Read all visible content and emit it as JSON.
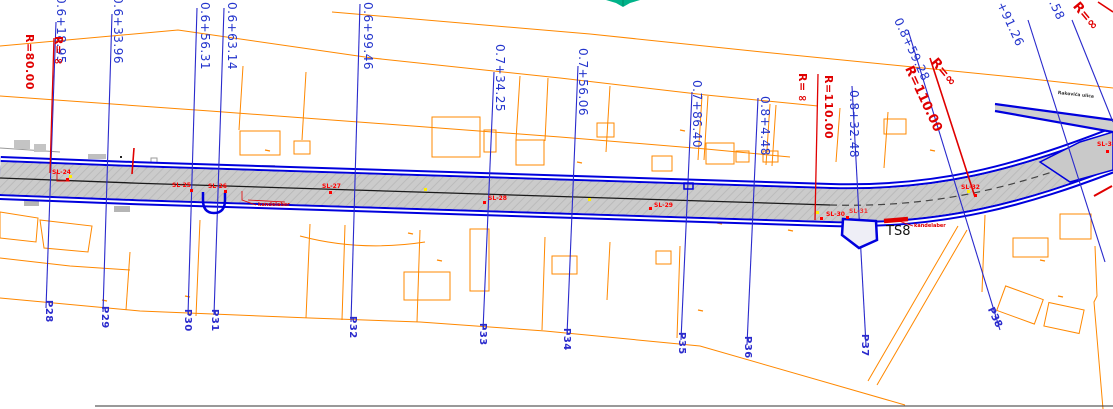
{
  "stations": [
    {
      "chainage": "0.6+18.95",
      "point": "P28"
    },
    {
      "chainage": "0.6+33.96",
      "point": "P29"
    },
    {
      "chainage": "0.6+56.31",
      "point": "P30"
    },
    {
      "chainage": "0.6+63.14",
      "point": "P31"
    },
    {
      "chainage": "0.6+99.46",
      "point": "P32"
    },
    {
      "chainage": "0.7+34.25",
      "point": "P33"
    },
    {
      "chainage": "0.7+56.06",
      "point": "P34"
    },
    {
      "chainage": "0.7+86.40",
      "point": "P35"
    },
    {
      "chainage": "0.8+4.48",
      "point": "P36"
    },
    {
      "chainage": "0.8+32.48",
      "point": "P37"
    },
    {
      "chainage": "0.8+59.28",
      "point": "P38"
    },
    {
      "chainage": "+91.26",
      "point": ""
    },
    {
      "chainage": ".58",
      "point": ""
    }
  ],
  "radius_labels": [
    {
      "value": "R=∞"
    },
    {
      "value": "R=80.00"
    },
    {
      "value": "R=∞"
    },
    {
      "value": "R=110.00"
    },
    {
      "value": "R=110.00"
    },
    {
      "value": "R=∞"
    },
    {
      "value": "R=∞"
    }
  ],
  "sl_points": [
    {
      "label": "SL-24"
    },
    {
      "label": "SL-25"
    },
    {
      "label": "SL-26"
    },
    {
      "label": "SL-27"
    },
    {
      "label": "SL-28"
    },
    {
      "label": "SL-29"
    },
    {
      "label": "SL-30"
    },
    {
      "label": "SL-31"
    },
    {
      "label": "SL-32"
    },
    {
      "label": "SL-33"
    }
  ],
  "labels": {
    "ts8": "TS8",
    "kandelaber_1": "kandelaber",
    "kandelaber_2": "kandelaber",
    "street_name": "Rakovića ulica"
  },
  "colors": {
    "parcel_line": "#ff8800",
    "section_line": "#2a2acc",
    "chainage_text": "#2233cc",
    "radius_text": "#e00000",
    "road_fill": "#c9c9c9",
    "road_edge_blue": "#0000dd",
    "centerline": "#1a1a1a",
    "sl_text": "#ff0000",
    "green_marker": "#00b389",
    "yellow_dot": "#ffee00"
  }
}
